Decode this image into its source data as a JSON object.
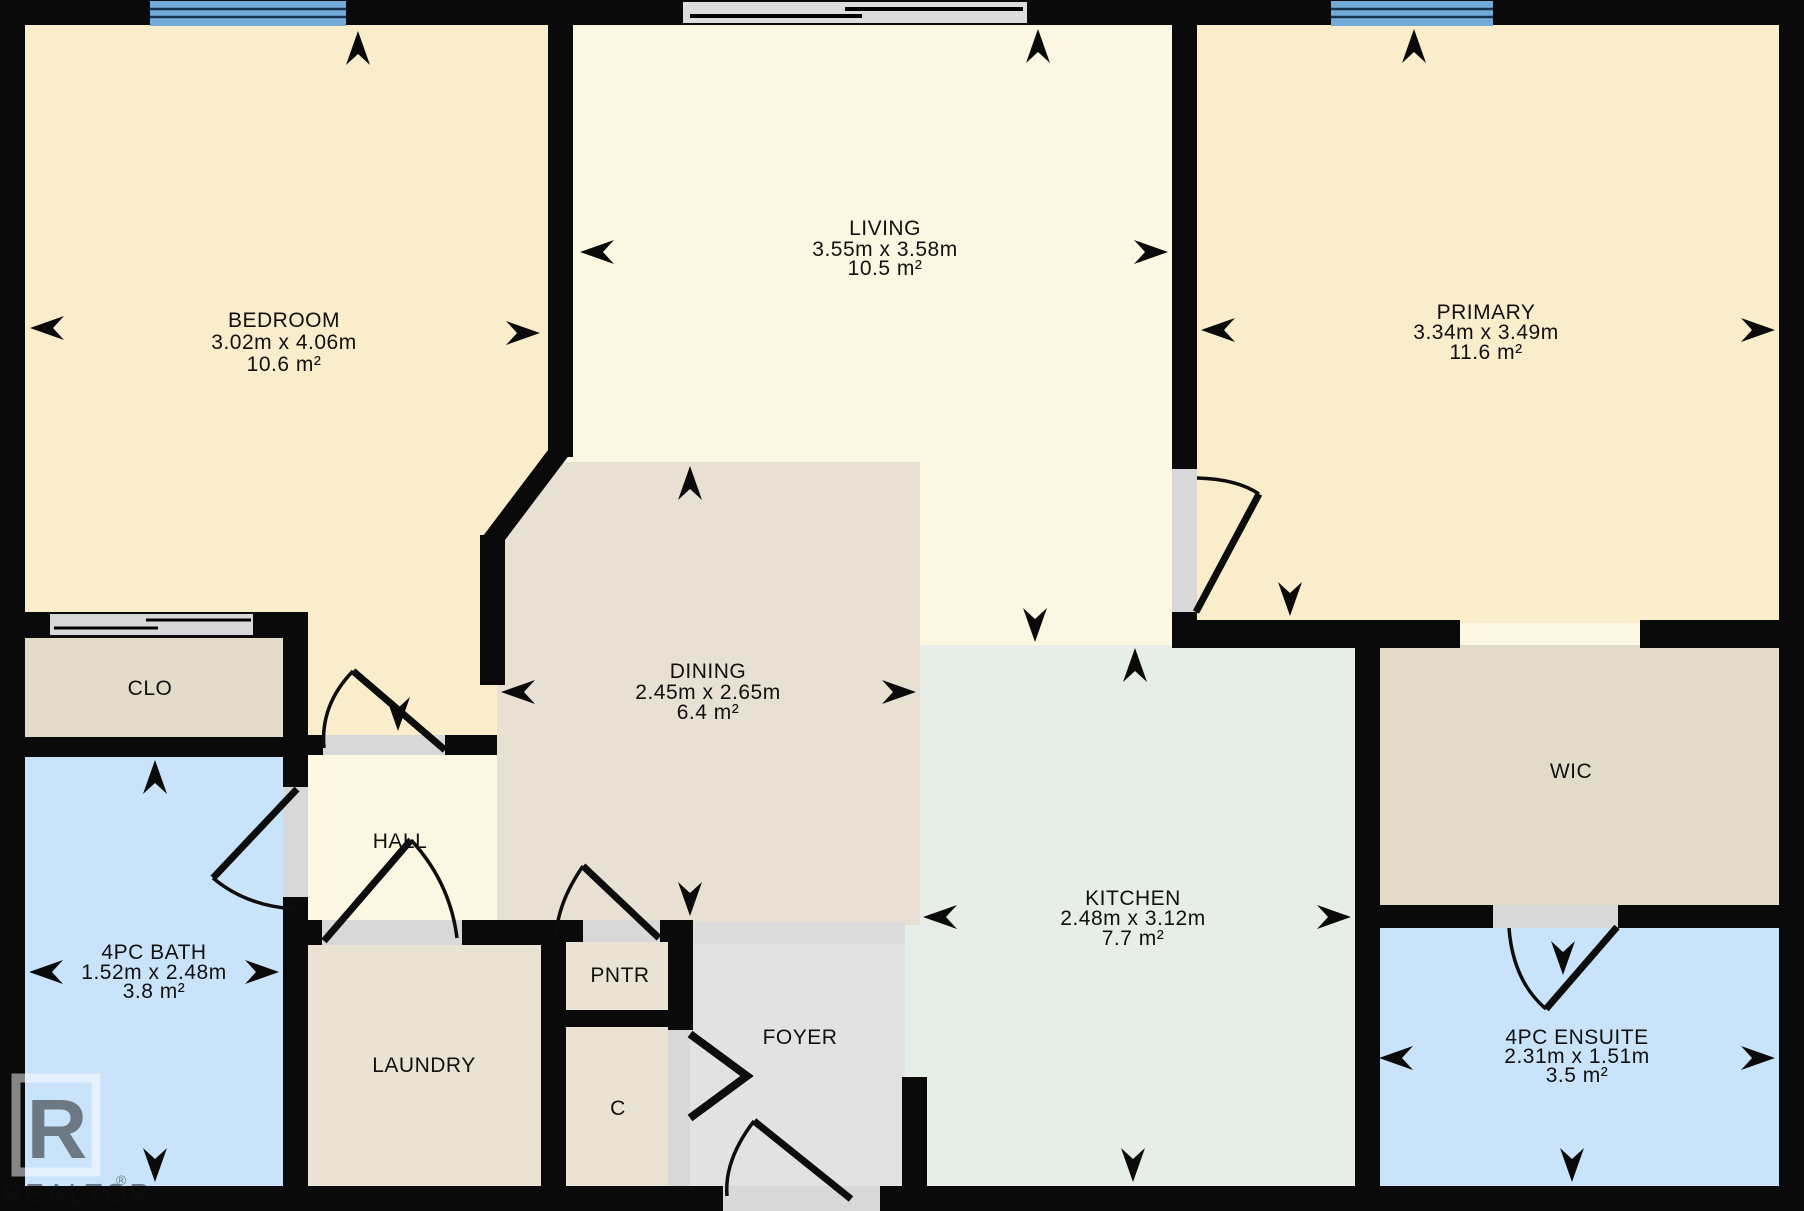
{
  "plan": {
    "colors": {
      "wall": "#0a0a0a",
      "floor_light": "#FCF7E2",
      "floor_warm": "#F9EDCB",
      "floor_greige": "#E8E1D3",
      "floor_closet": "#E3DBC9",
      "floor_beige": "#EAE2D2",
      "floor_blue": "#C9E4FA",
      "floor_mint": "#E7EEE8",
      "floor_gray": "#E2E2E2",
      "door": "#D8D8D8",
      "window": "#72ABD8"
    },
    "rooms": {
      "bedroom": {
        "name": "BEDROOM",
        "dims": "3.02m x 4.06m",
        "area": "10.6 m²"
      },
      "living": {
        "name": "LIVING",
        "dims": "3.55m x 3.58m",
        "area": "10.5 m²"
      },
      "primary": {
        "name": "PRIMARY",
        "dims": "3.34m x 3.49m",
        "area": "11.6 m²"
      },
      "dining": {
        "name": "DINING",
        "dims": "2.45m x 2.65m",
        "area": "6.4 m²"
      },
      "kitchen": {
        "name": "KITCHEN",
        "dims": "2.48m x 3.12m",
        "area": "7.7 m²"
      },
      "bath": {
        "name": "4PC BATH",
        "dims": "1.52m x 2.48m",
        "area": "3.8 m²"
      },
      "ensuite": {
        "name": "4PC ENSUITE",
        "dims": "2.31m x 1.51m",
        "area": "3.5 m²"
      },
      "clo": {
        "name": "CLO"
      },
      "hall": {
        "name": "HALL"
      },
      "laundry": {
        "name": "LAUNDRY"
      },
      "pntr": {
        "name": "PNTR"
      },
      "closet": {
        "name": "C"
      },
      "foyer": {
        "name": "FOYER"
      },
      "wic": {
        "name": "WIC"
      }
    },
    "watermark": {
      "logo_letter": "R",
      "brand": "REALTOR",
      "registered": "®"
    }
  }
}
